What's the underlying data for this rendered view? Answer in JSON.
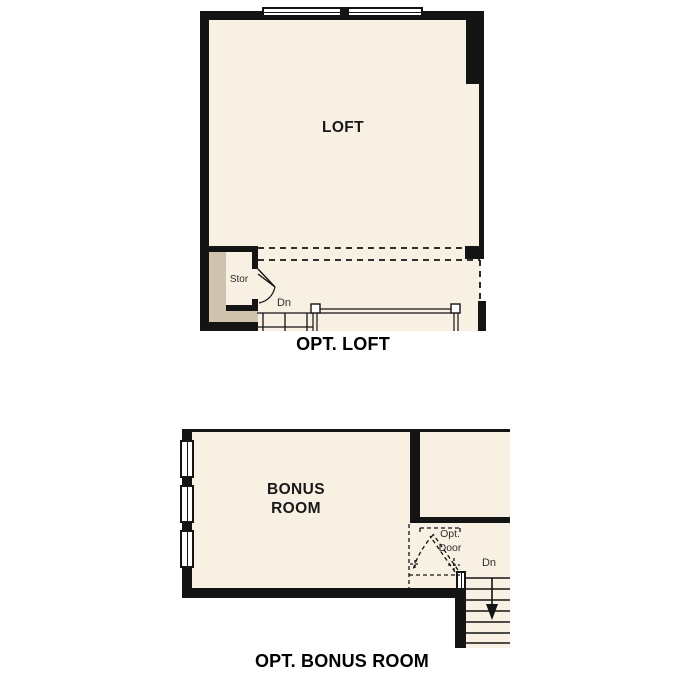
{
  "colors": {
    "floor": "#f7f0e3",
    "wall": "#141414",
    "tan": "#cfc3ae",
    "ink": "#1c1c1c"
  },
  "loft_plan": {
    "room_label": "LOFT",
    "storage_label": "Stor",
    "down_label": "Dn",
    "caption": "OPT. LOFT"
  },
  "bonus_plan": {
    "room_label_line1": "BONUS",
    "room_label_line2": "ROOM",
    "opt_door_line1": "Opt.",
    "opt_door_line2": "Door",
    "down_label": "Dn",
    "caption": "OPT. BONUS ROOM"
  }
}
